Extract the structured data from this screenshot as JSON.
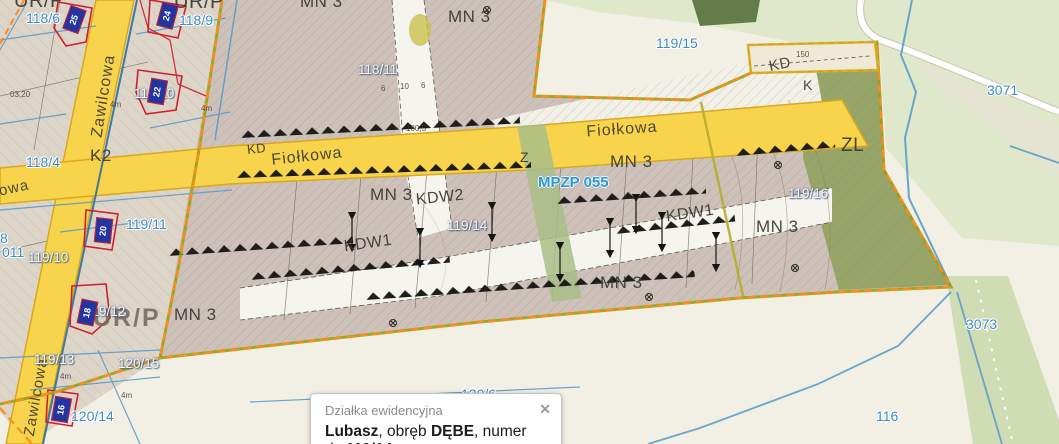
{
  "colors": {
    "road_yellow": "#f8d44c",
    "road_casing": "#d8a81c",
    "boundary_orange": "#ff8c1a",
    "boundary_olive": "#9aa019",
    "water_blue": "#5b9ec9",
    "parcel_label_blue": "#3e8ac8",
    "plan_raster_pink": "#cec1b9",
    "cadastre_beige": "#ddd6c8",
    "forest_green": "#93a364",
    "osm_green": "#dfe8cb",
    "cream": "#f2efe4",
    "marker_blue": "#2335a0",
    "building_red": "#cf2030",
    "mpzp_blue": "#2e9ad4"
  },
  "map": {
    "street_labels": [
      {
        "text": "Zawilcowa",
        "x": 104,
        "y": 96,
        "rot": -81,
        "fs": 16
      },
      {
        "text": "Zawilcowa",
        "x": 36,
        "y": 397,
        "rot": -80,
        "fs": 15
      },
      {
        "text": "Fiołkowa",
        "x": 307,
        "y": 157,
        "rot": -6,
        "fs": 16
      },
      {
        "text": "Fiołkowa",
        "x": 622,
        "y": 130,
        "rot": -4,
        "fs": 16
      },
      {
        "text": "owa",
        "x": 14,
        "y": 188,
        "rot": -12,
        "fs": 15
      }
    ],
    "zone_labels": [
      {
        "text": "UR/P",
        "x": 14,
        "y": -9,
        "fs": 20
      },
      {
        "text": "UR/P",
        "x": 174,
        "y": -8,
        "fs": 20
      },
      {
        "text": "UR/P",
        "x": 93,
        "y": 306,
        "fs": 25,
        "cls": "big"
      },
      {
        "text": "K2",
        "x": 90,
        "y": 147,
        "fs": 17
      },
      {
        "text": "KD",
        "x": 247,
        "y": 142,
        "fs": 13,
        "rot": -6
      },
      {
        "text": "KD",
        "x": 769,
        "y": 57,
        "fs": 15,
        "rot": -12
      },
      {
        "text": "K",
        "x": 803,
        "y": 78,
        "fs": 14
      },
      {
        "text": "Z",
        "x": 520,
        "y": 150,
        "fs": 14
      },
      {
        "text": "ZL",
        "x": 841,
        "y": 136,
        "fs": 19
      },
      {
        "text": "MN 3",
        "x": 300,
        "y": -7,
        "fs": 17
      },
      {
        "text": "MN 3",
        "x": 448,
        "y": 8,
        "fs": 17
      },
      {
        "text": "MN 3",
        "x": 610,
        "y": 153,
        "fs": 17
      },
      {
        "text": "MN 3",
        "x": 370,
        "y": 186,
        "fs": 17
      },
      {
        "text": "MN 3",
        "x": 756,
        "y": 218,
        "fs": 17
      },
      {
        "text": "MN 3",
        "x": 600,
        "y": 274,
        "fs": 17
      },
      {
        "text": "MN 3",
        "x": 174,
        "y": 306,
        "fs": 17
      },
      {
        "text": "KDW2",
        "x": 416,
        "y": 190,
        "fs": 16,
        "rot": -6
      },
      {
        "text": "KDW1",
        "x": 344,
        "y": 236,
        "fs": 16,
        "rot": -8
      },
      {
        "text": "KDW1",
        "x": 666,
        "y": 206,
        "fs": 16,
        "rot": -8
      }
    ],
    "parcel_labels": [
      {
        "text": "118/6",
        "x": 26,
        "y": 11,
        "variant": "blue"
      },
      {
        "text": "118/9",
        "x": 179,
        "y": 13,
        "variant": "blue"
      },
      {
        "text": "118/4",
        "x": 26,
        "y": 155,
        "variant": "blue"
      },
      {
        "text": "119/11",
        "x": 126,
        "y": 217,
        "variant": "blue"
      },
      {
        "text": "8",
        "x": 0,
        "y": 231,
        "variant": "blue"
      },
      {
        "text": "011",
        "x": 2,
        "y": 245,
        "variant": "blue"
      },
      {
        "text": "120/14",
        "x": 71,
        "y": 409,
        "variant": "blue"
      },
      {
        "text": "119/15",
        "x": 656,
        "y": 36,
        "variant": "blue"
      },
      {
        "text": "120/6",
        "x": 461,
        "y": 387,
        "variant": "blue"
      },
      {
        "text": "3071",
        "x": 987,
        "y": 83,
        "variant": "blue"
      },
      {
        "text": "3073",
        "x": 966,
        "y": 317,
        "variant": "blue"
      },
      {
        "text": "116",
        "x": 876,
        "y": 409,
        "variant": "blue"
      },
      {
        "text": "118/10",
        "x": 134,
        "y": 87,
        "variant": "white"
      },
      {
        "text": "119/10",
        "x": 28,
        "y": 251,
        "variant": "white"
      },
      {
        "text": "118/11",
        "x": 358,
        "y": 63,
        "variant": "white"
      },
      {
        "text": "119/14",
        "x": 447,
        "y": 219,
        "variant": "white"
      },
      {
        "text": "119/12",
        "x": 85,
        "y": 305,
        "variant": "white"
      },
      {
        "text": "119/13",
        "x": 34,
        "y": 353,
        "variant": "white"
      },
      {
        "text": "120/15",
        "x": 118,
        "y": 357,
        "variant": "white"
      },
      {
        "text": "119/16",
        "x": 788,
        "y": 187,
        "variant": "white"
      }
    ],
    "annotations": [
      {
        "text": "4m",
        "x": 110,
        "y": 101
      },
      {
        "text": "4m",
        "x": 201,
        "y": 105
      },
      {
        "text": "4m",
        "x": 60,
        "y": 373
      },
      {
        "text": "4m",
        "x": 121,
        "y": 392
      },
      {
        "text": "03,20",
        "x": 10,
        "y": 91
      },
      {
        "text": "6",
        "x": 381,
        "y": 85
      },
      {
        "text": "10",
        "x": 400,
        "y": 83
      },
      {
        "text": "6",
        "x": 421,
        "y": 82
      },
      {
        "text": "180,5",
        "x": 406,
        "y": 125
      },
      {
        "text": "150",
        "x": 796,
        "y": 51
      }
    ],
    "mpzp": {
      "text": "MPZP 055",
      "x": 538,
      "y": 175
    },
    "markers": [
      {
        "num": "25",
        "x": 66,
        "y": 7,
        "rot": 20
      },
      {
        "num": "24",
        "x": 159,
        "y": 3,
        "rot": 15
      },
      {
        "num": "22",
        "x": 149,
        "y": 79,
        "rot": 10
      },
      {
        "num": "20",
        "x": 95,
        "y": 218,
        "rot": 6
      },
      {
        "num": "18",
        "x": 79,
        "y": 300,
        "rot": 12
      },
      {
        "num": "16",
        "x": 53,
        "y": 397,
        "rot": 10
      }
    ]
  },
  "popup": {
    "title": "Działka ewidencyjna",
    "close_icon": "✕",
    "parcel_name": "Lubasz",
    "sep1": ", obręb ",
    "obreb": "DĘBE",
    "sep2": ", numer dz.",
    "number": "119/14"
  }
}
